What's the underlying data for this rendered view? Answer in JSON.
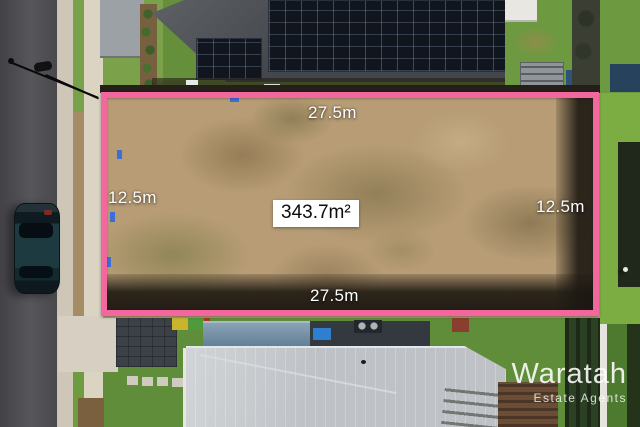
{
  "photo": {
    "type": "aerial-drone-photo",
    "description": "Top-down aerial drone photo of a vacant residential land lot outlined in pink, between a dark-roofed house with solar panels (top) and a light grey metal-roofed house (bottom), street with parked car and streetlight at left, neighbouring lawns at right",
    "watermark": {
      "brand": "Waratah",
      "tagline": "Estate Agents"
    }
  },
  "overlay": {
    "area_label": "343.7m²",
    "dimensions": {
      "top": "27.5m",
      "bottom": "27.5m",
      "left": "12.5m",
      "right": "12.5m"
    },
    "boundary_color": "#f4679e"
  },
  "palette": {
    "boundary_pink": "#f4679e",
    "road_asphalt": "#4e4e52",
    "lot_dirt": "#b79c75",
    "lawn_green": "#6f9c3e",
    "bright_lawn": "#7cad42",
    "dark_roof": "#43474c",
    "solar_panel": "#11161e",
    "light_metal_roof": "#c4c8cb",
    "pool_shed_blue": "#5d7c96",
    "footpath_concrete": "#dbd4c3",
    "car_teal": "#1d3a40",
    "label_text": "#ffffff",
    "area_box_bg": "#ffffff"
  }
}
